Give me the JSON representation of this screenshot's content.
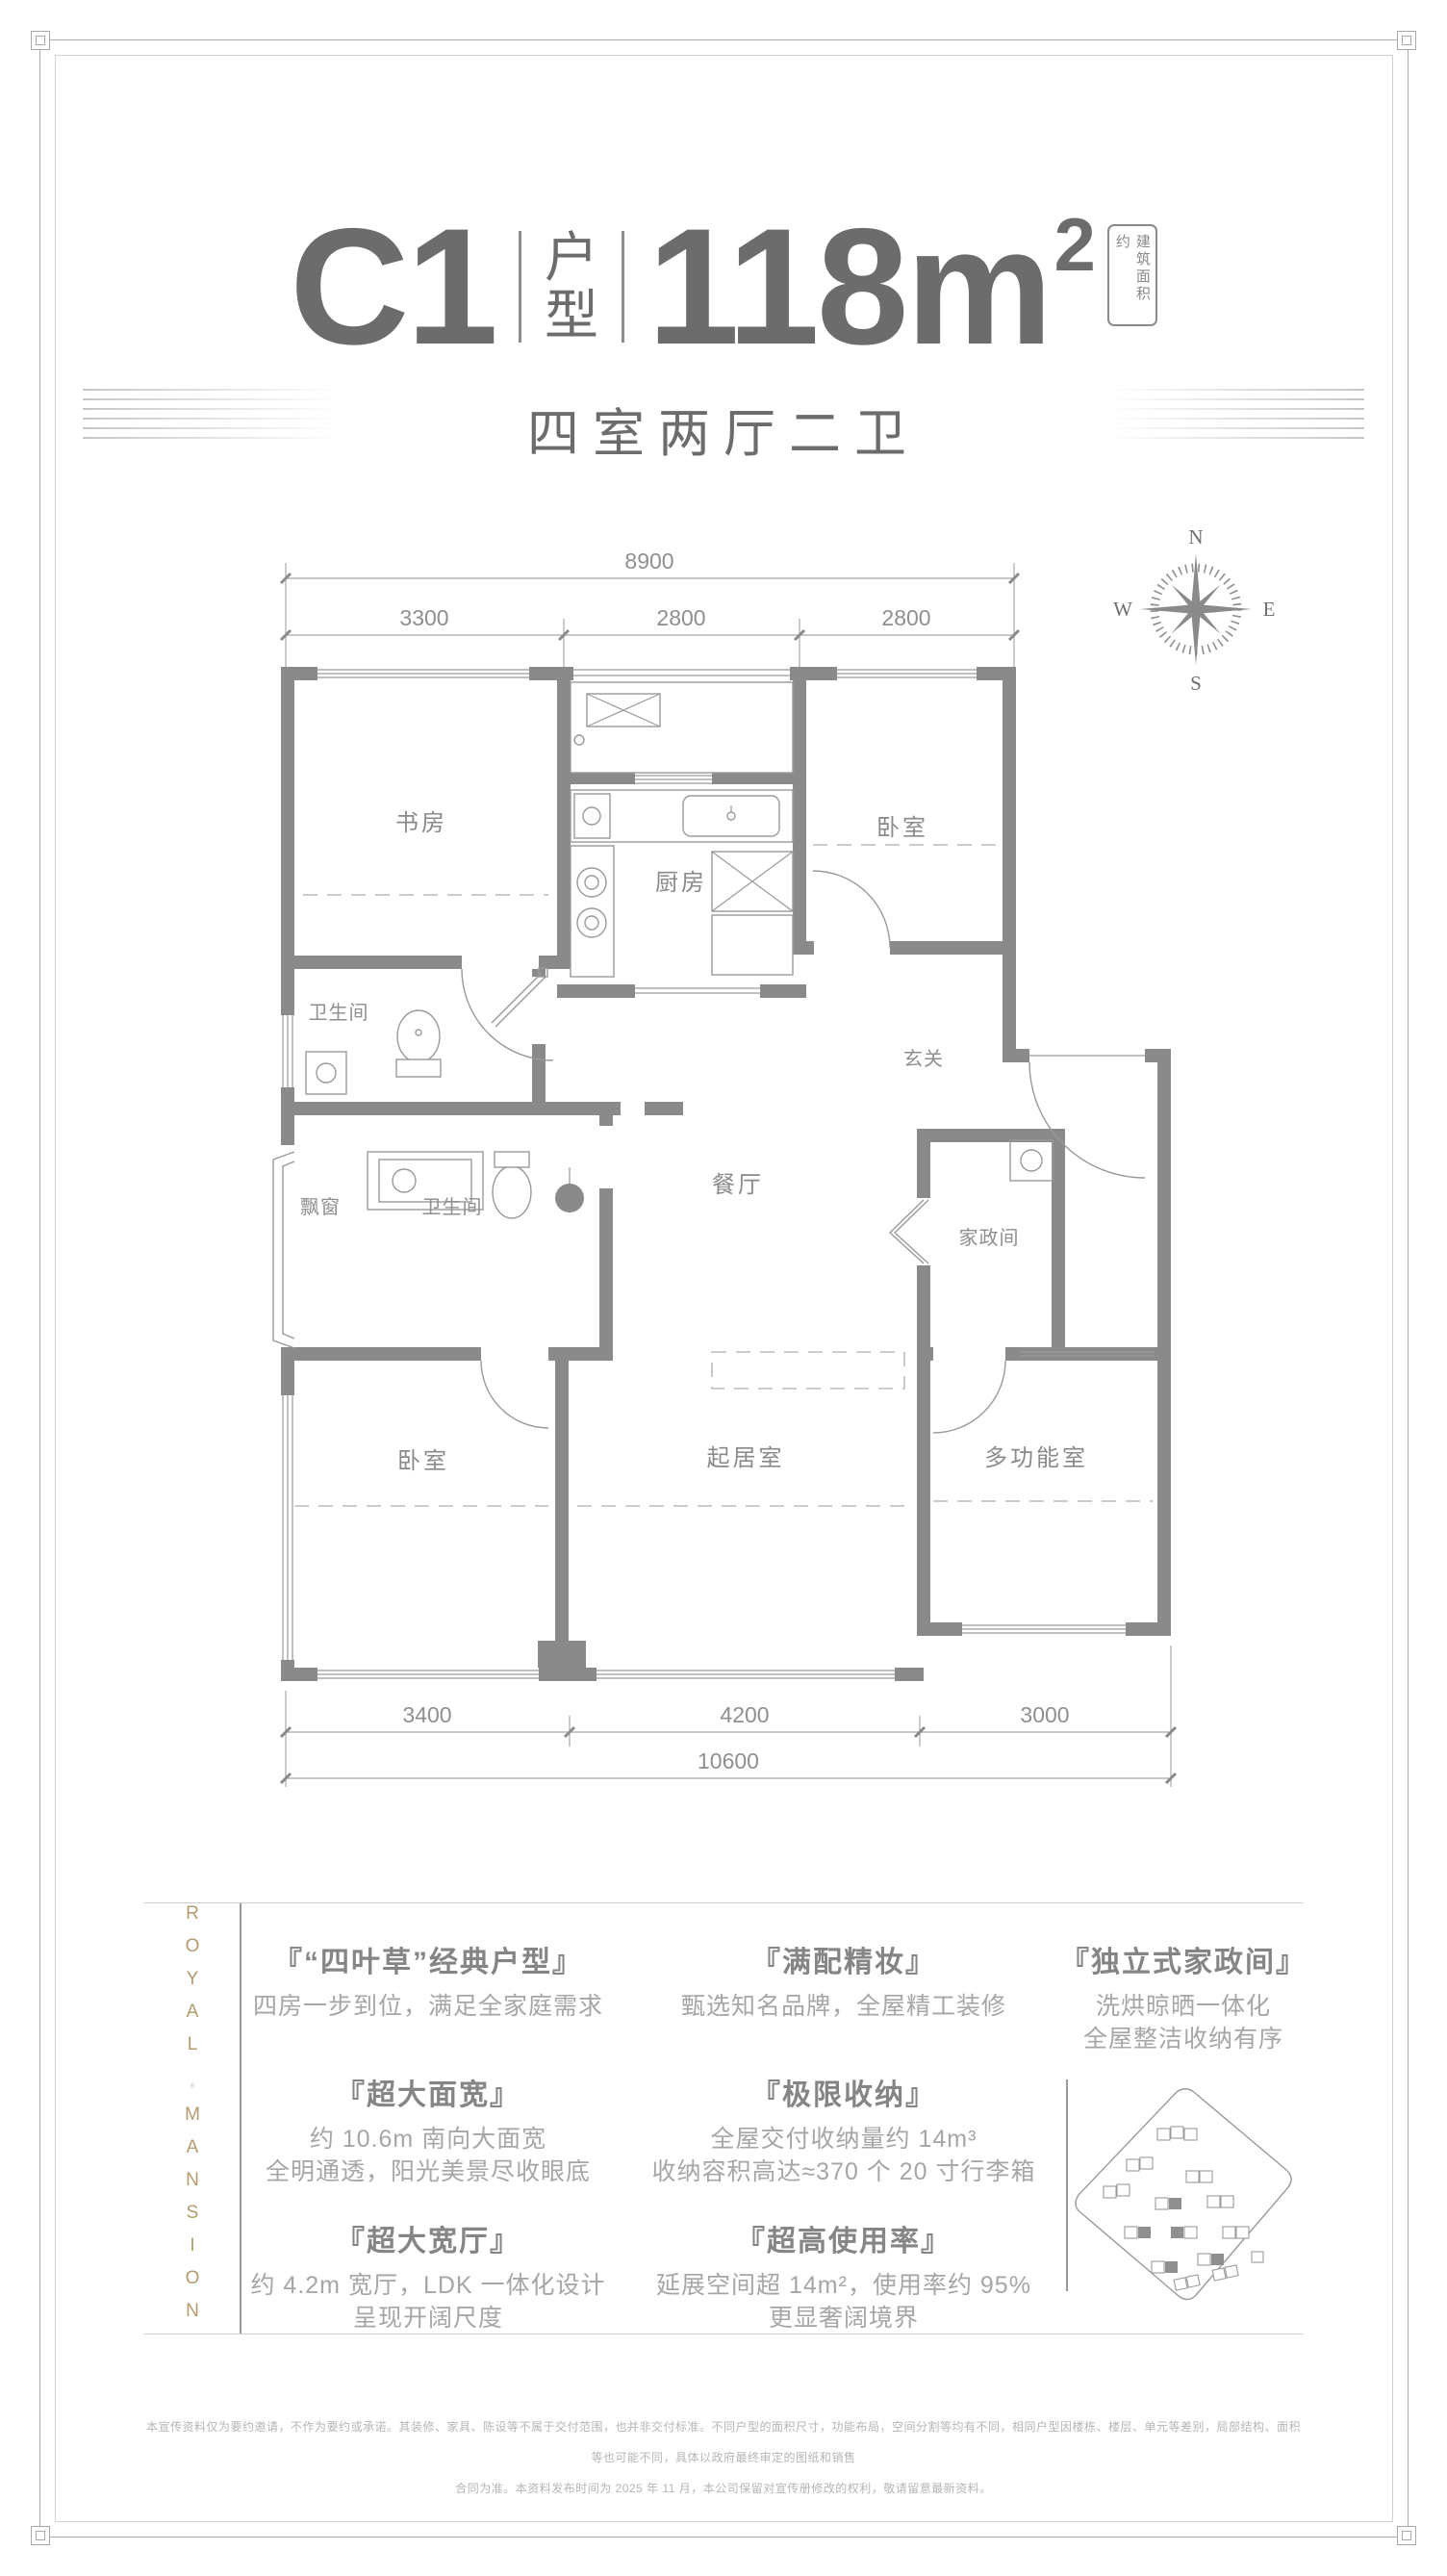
{
  "colors": {
    "accent_gold": "#b49b6e",
    "wall_gray": "#8a8a8a",
    "title_gray": "#6c6c6c"
  },
  "header": {
    "unit": "C1",
    "unit_label_1": "户",
    "unit_label_2": "型",
    "area": "118m",
    "area_sup": "2",
    "area_tag": "建筑面积约",
    "subtitle": "四室两厅二卫"
  },
  "compass": {
    "n": "N",
    "e": "E",
    "s": "S",
    "w": "W"
  },
  "plan": {
    "rooms": {
      "study": "书房",
      "kitchen": "厨房",
      "bedroom_top": "卧室",
      "bath_top": "卫生间",
      "entry": "玄关",
      "dining": "餐厅",
      "housekeeping": "家政间",
      "bay_window": "飘窗",
      "bath_main": "卫生间",
      "bedroom_main": "卧室",
      "living": "起居室",
      "multi": "多功能室"
    },
    "dims_top": {
      "overall": "8900",
      "seg1": "3300",
      "seg2": "2800",
      "seg3": "2800"
    },
    "dims_bottom": {
      "seg1": "3400",
      "seg2": "4200",
      "seg3": "3000",
      "overall": "10600"
    }
  },
  "brand": {
    "line1": "ROYAL",
    "line2": "MANSION"
  },
  "features": {
    "col1": [
      {
        "title": "『“四叶草”经典户型』",
        "lines": [
          "四房一步到位，满足全家庭需求"
        ]
      },
      {
        "title": "『超大面宽』",
        "lines": [
          "约 10.6m 南向大面宽",
          "全明通透，阳光美景尽收眼底"
        ]
      },
      {
        "title": "『超大宽厅』",
        "lines": [
          "约 4.2m 宽厅，LDK 一体化设计",
          "呈现开阔尺度"
        ]
      }
    ],
    "col2": [
      {
        "title": "『满配精妆』",
        "lines": [
          "甄选知名品牌，全屋精工装修"
        ]
      },
      {
        "title": "『极限收纳』",
        "lines": [
          "全屋交付收纳量约 14m³",
          "收纳容积高达≈370 个 20 寸行李箱"
        ]
      },
      {
        "title": "『超高使用率』",
        "lines": [
          "延展空间超 14m²，使用率约 95%",
          "更显奢阔境界"
        ]
      }
    ],
    "col3": [
      {
        "title": "『独立式家政间』",
        "lines": [
          "洗烘晾晒一体化",
          "全屋整洁收纳有序"
        ]
      }
    ]
  },
  "disclaimer": {
    "line1": "本宣传资料仅为要约邀请，不作为要约或承诺。其装修、家具、陈设等不属于交付范围，也并非交付标准。不同户型的面积尺寸，功能布局，空间分割等均有不同，相同户型因楼栋、楼层、单元等差别，局部结构、面积等也可能不同，具体以政府最终审定的图纸和销售",
    "line2": "合同为准。本资料发布时间为 2025 年 11 月，本公司保留对宣传册修改的权利，敬请留意最新资料。"
  }
}
